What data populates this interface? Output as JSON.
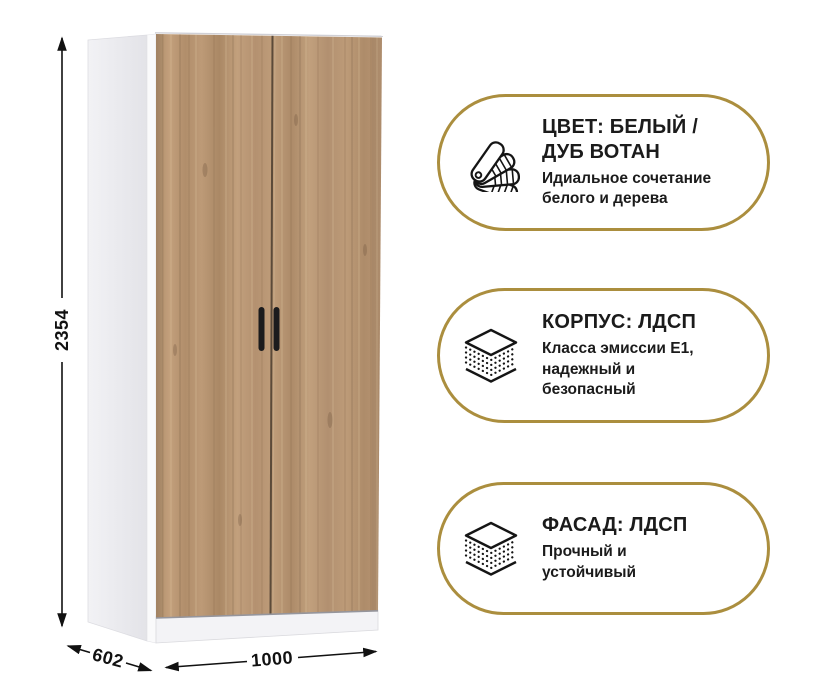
{
  "product": {
    "type": "wardrobe-two-door",
    "dimensions": {
      "height_mm": "2354",
      "depth_mm": "602",
      "width_mm": "1000"
    }
  },
  "colors": {
    "accent_gold": "#ab8e3e",
    "text": "#1b1b1b",
    "wood_base": "#b89673",
    "carcass_white": "#f2f2f5"
  },
  "features": [
    {
      "icon": "color-swatch-fan-icon",
      "title_lines": [
        "ЦВЕТ: БЕЛЫЙ /",
        "ДУБ ВОТАН"
      ],
      "subtitle_lines": [
        "Идиальное сочетание",
        "белого и дерева"
      ]
    },
    {
      "icon": "layered-board-icon",
      "title_lines": [
        "КОРПУС: ЛДСП"
      ],
      "subtitle_lines": [
        "Класса эмиссии Е1,",
        "надежный и",
        "безопасный"
      ]
    },
    {
      "icon": "layered-board-icon",
      "title_lines": [
        "ФАСАД: ЛДСП"
      ],
      "subtitle_lines": [
        "Прочный и",
        "устойчивый"
      ]
    }
  ]
}
